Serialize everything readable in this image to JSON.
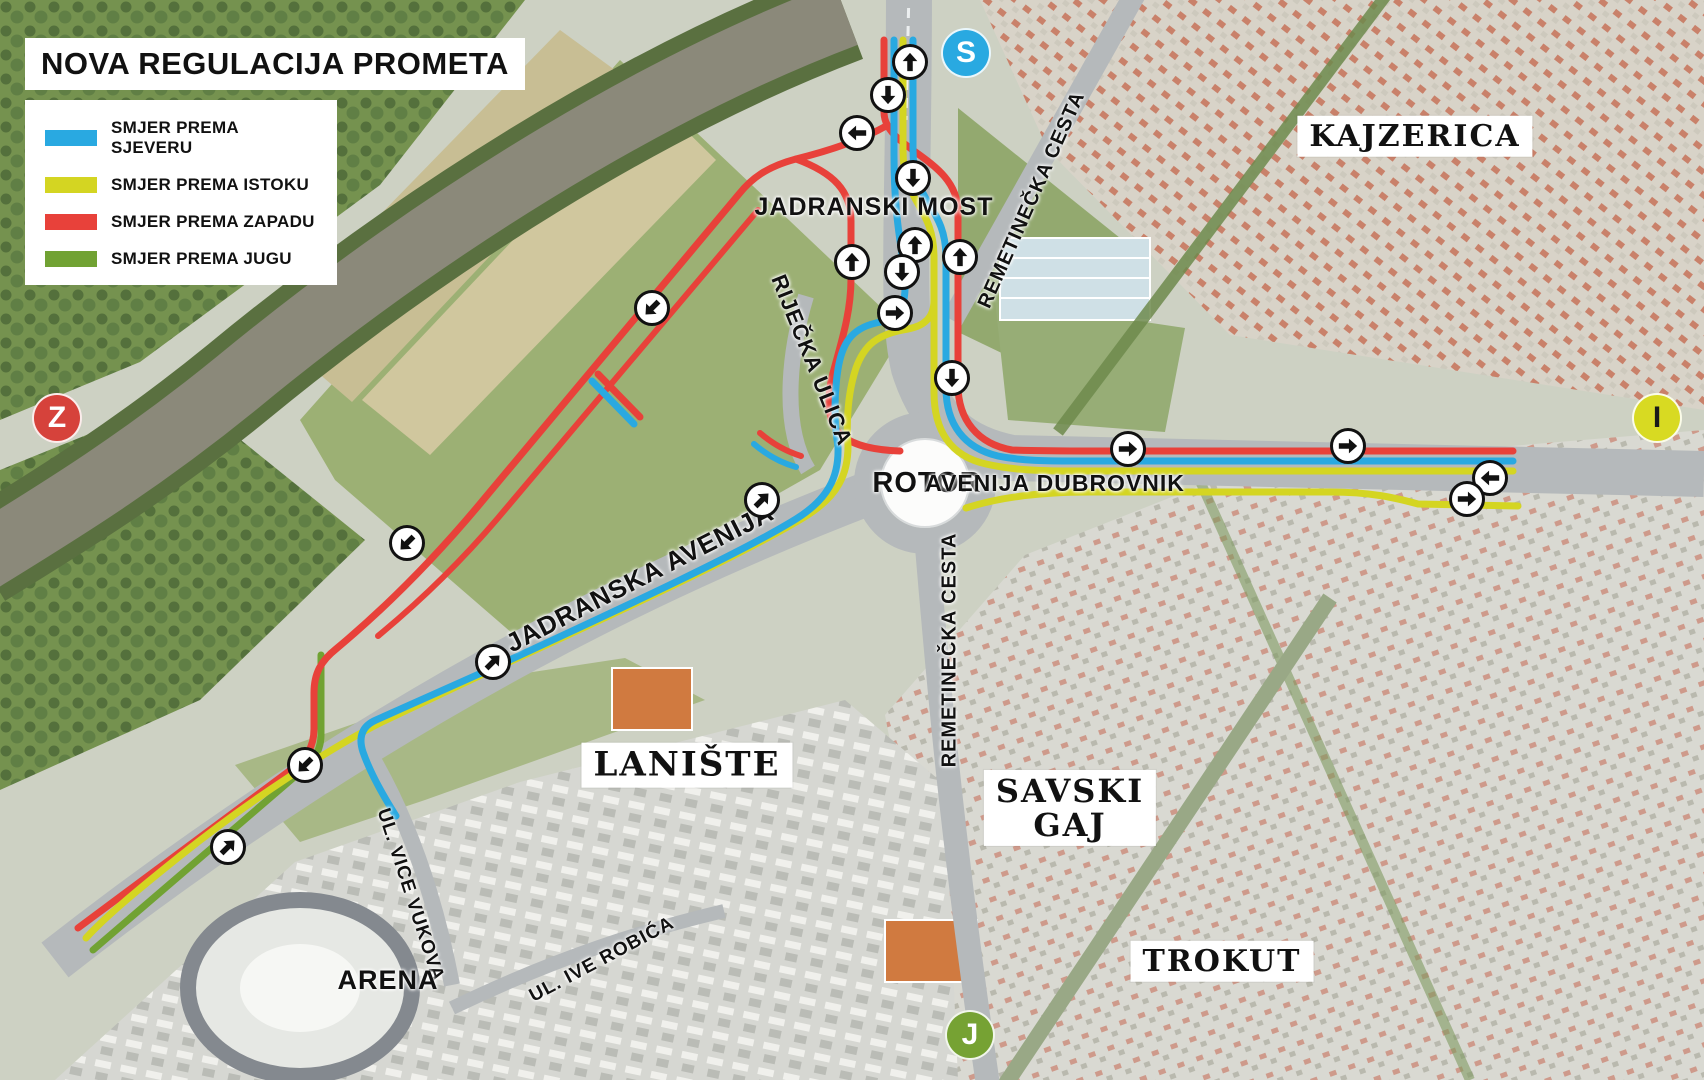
{
  "title": "NOVA REGULACIJA PROMETA",
  "legend": {
    "items": [
      {
        "key": "north",
        "label": "SMJER PREMA SJEVERU",
        "color": "#29a9e1"
      },
      {
        "key": "east",
        "label": "SMJER PREMA ISTOKU",
        "color": "#d4d522"
      },
      {
        "key": "west",
        "label": "SMJER PREMA ZAPADU",
        "color": "#e8413a"
      },
      {
        "key": "south",
        "label": "SMJER PREMA JUGU",
        "color": "#71a233"
      }
    ]
  },
  "markers": [
    {
      "letter": "S",
      "x": 966,
      "y": 53,
      "bg": "#29a9e1",
      "fg": "#ffffff"
    },
    {
      "letter": "Z",
      "x": 57,
      "y": 418,
      "bg": "#d6423b",
      "fg": "#ffffff"
    },
    {
      "letter": "I",
      "x": 1657,
      "y": 418,
      "bg": "#d8da22",
      "fg": "#1a1a1a"
    },
    {
      "letter": "J",
      "x": 970,
      "y": 1035,
      "bg": "#76a233",
      "fg": "#ffffff"
    }
  ],
  "map": {
    "labels": [
      {
        "text": "KAJZERICA",
        "x": 1415,
        "y": 136,
        "rot": 0,
        "style": "box",
        "size": 30
      },
      {
        "text": "LANIŠTE",
        "x": 687,
        "y": 765,
        "rot": 0,
        "style": "box",
        "size": 34
      },
      {
        "text": "SAVSKI\nGAJ",
        "x": 1070,
        "y": 808,
        "rot": 0,
        "style": "box",
        "size": 32
      },
      {
        "text": "TROKUT",
        "x": 1222,
        "y": 961,
        "rot": 0,
        "style": "box",
        "size": 30
      },
      {
        "text": "JADRANSKI MOST",
        "x": 874,
        "y": 207,
        "rot": 0,
        "style": "street",
        "size": 25
      },
      {
        "text": "ROTOR",
        "x": 927,
        "y": 483,
        "rot": 0,
        "style": "street",
        "size": 29
      },
      {
        "text": "AVENIJA DUBROVNIK",
        "x": 1055,
        "y": 483,
        "rot": 0,
        "style": "street",
        "size": 23
      },
      {
        "text": "RIJEČKA ULICA",
        "x": 812,
        "y": 360,
        "rot": 68,
        "style": "street",
        "size": 22
      },
      {
        "text": "JADRANSKA AVENIJA",
        "x": 640,
        "y": 578,
        "rot": -27,
        "style": "street",
        "size": 26
      },
      {
        "text": "REMETINEČKA CESTA",
        "x": 1032,
        "y": 200,
        "rot": -66,
        "style": "street",
        "size": 20
      },
      {
        "text": "REMETINEČKA CESTA",
        "x": 950,
        "y": 650,
        "rot": -90,
        "style": "street",
        "size": 20
      },
      {
        "text": "UL. VICE VUKOVA",
        "x": 410,
        "y": 895,
        "rot": 72,
        "style": "street",
        "size": 19
      },
      {
        "text": "UL. IVE ROBIĆA",
        "x": 602,
        "y": 960,
        "rot": -28,
        "style": "street",
        "size": 19
      },
      {
        "text": "ARENA",
        "x": 388,
        "y": 980,
        "rot": 0,
        "style": "street",
        "size": 27
      }
    ],
    "arrows": [
      {
        "x": 910,
        "y": 62,
        "rot": 0
      },
      {
        "x": 888,
        "y": 95,
        "rot": 180
      },
      {
        "x": 857,
        "y": 133,
        "rot": 270
      },
      {
        "x": 913,
        "y": 178,
        "rot": 180
      },
      {
        "x": 915,
        "y": 245,
        "rot": 0
      },
      {
        "x": 852,
        "y": 262,
        "rot": 0
      },
      {
        "x": 960,
        "y": 257,
        "rot": 0
      },
      {
        "x": 902,
        "y": 272,
        "rot": 180
      },
      {
        "x": 895,
        "y": 313,
        "rot": 90
      },
      {
        "x": 952,
        "y": 378,
        "rot": 180
      },
      {
        "x": 652,
        "y": 308,
        "rot": 225
      },
      {
        "x": 407,
        "y": 543,
        "rot": 225
      },
      {
        "x": 762,
        "y": 500,
        "rot": 45
      },
      {
        "x": 493,
        "y": 662,
        "rot": 45
      },
      {
        "x": 305,
        "y": 765,
        "rot": 225
      },
      {
        "x": 228,
        "y": 847,
        "rot": 45
      },
      {
        "x": 1128,
        "y": 449,
        "rot": 90
      },
      {
        "x": 1348,
        "y": 446,
        "rot": 90
      },
      {
        "x": 1490,
        "y": 478,
        "rot": 270
      },
      {
        "x": 1467,
        "y": 499,
        "rot": 90
      }
    ]
  }
}
